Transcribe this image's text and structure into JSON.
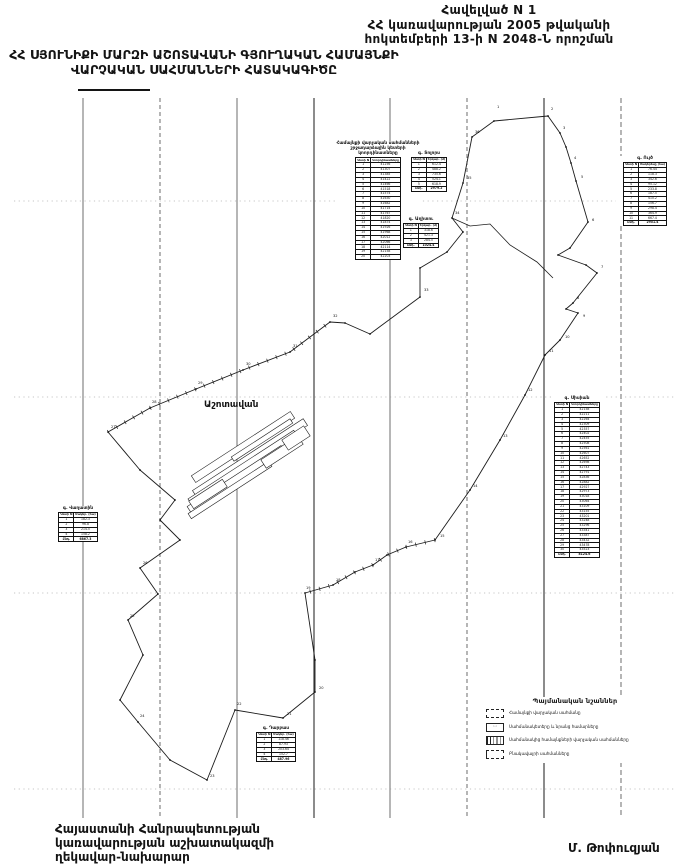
{
  "header": {
    "lines": [
      "Հավելված  N   1",
      "ՀՀ կառավարության 2005 թվականի",
      "հոկտեմբերի 13-ի N 2048-Ն որոշման"
    ]
  },
  "title": {
    "lines": [
      "ՀՀ ՍՅՈՒՆԻՔԻ ՄԱՐԶԻ ԱՇՈՏԱՎԱՆԻ ԳՅՈՒՂԱԿԱՆ ՀԱՄԱՅՆՔԻ",
      "ՎԱՐՉԱԿԱՆ  ՍԱՀՄԱՆՆԵՐԻ  ՀԱՏԱԿԱԳԻԾԸ"
    ]
  },
  "footer": {
    "lines": [
      "Հայաստանի Հանրապետության",
      "կառավարության աշխատակազմի",
      "ղեկավար-նախարար"
    ],
    "signature": "Մ. Թոփուզյան"
  },
  "legend": {
    "title": "Պայմանական նշաններ",
    "items": [
      {
        "label": "Համայնքի վարչական սահմանը"
      },
      {
        "label": "Սահմանակետերը և նրանց համարները"
      },
      {
        "label": "Սահմանակից համայնքների վարչական սահմանները"
      },
      {
        "label": "Բնակավայրի սահմանները"
      }
    ]
  },
  "map": {
    "settlement_label": "Աշոտավան",
    "grid_x": [
      {
        "x": 83
      },
      {
        "x": 160,
        "dash": "4 3"
      },
      {
        "x": 237
      },
      {
        "x": 314,
        "w": 1.1
      },
      {
        "x": 390
      },
      {
        "x": 467,
        "dash": "4 3"
      },
      {
        "x": 544,
        "w": 1.1
      },
      {
        "x": 621,
        "dash": "5 3"
      }
    ],
    "grid_y": [
      201,
      397,
      593,
      789
    ],
    "boundary": [
      [
        108,
        432
      ],
      [
        150,
        408
      ],
      [
        196,
        389
      ],
      [
        243,
        370
      ],
      [
        290,
        352
      ],
      [
        330,
        322
      ],
      [
        345,
        323
      ],
      [
        370,
        334
      ],
      [
        420,
        297
      ],
      [
        420,
        268
      ],
      [
        447,
        252
      ],
      [
        463,
        232
      ],
      [
        452,
        218
      ],
      [
        463,
        183
      ],
      [
        472,
        137
      ],
      [
        494,
        121
      ],
      [
        548,
        116
      ],
      [
        560,
        133
      ],
      [
        566,
        147
      ],
      [
        571,
        163
      ],
      [
        576,
        181
      ],
      [
        588,
        222
      ],
      [
        570,
        248
      ],
      [
        558,
        255
      ],
      [
        586,
        265
      ],
      [
        597,
        273
      ],
      [
        573,
        303
      ],
      [
        566,
        309
      ],
      [
        578,
        313
      ],
      [
        560,
        340
      ],
      [
        545,
        355
      ],
      [
        525,
        395
      ],
      [
        500,
        440
      ],
      [
        470,
        490
      ],
      [
        435,
        540
      ],
      [
        406,
        547
      ],
      [
        387,
        555
      ],
      [
        373,
        565
      ],
      [
        355,
        572
      ],
      [
        333,
        585
      ],
      [
        305,
        593
      ],
      [
        315,
        660
      ],
      [
        315,
        692
      ],
      [
        283,
        718
      ],
      [
        235,
        710
      ],
      [
        207,
        780
      ],
      [
        170,
        760
      ],
      [
        138,
        722
      ],
      [
        120,
        700
      ],
      [
        143,
        655
      ],
      [
        128,
        620
      ],
      [
        158,
        594
      ],
      [
        140,
        568
      ],
      [
        180,
        540
      ],
      [
        160,
        520
      ],
      [
        175,
        500
      ],
      [
        140,
        470
      ]
    ],
    "internal_lines": [
      [
        [
          452,
          218
        ],
        [
          470,
          226
        ],
        [
          490,
          224
        ],
        [
          510,
          245
        ],
        [
          537,
          262
        ],
        [
          553,
          278
        ]
      ]
    ],
    "ticked": [
      [
        [
          108,
          432
        ],
        [
          150,
          408
        ],
        [
          196,
          389
        ],
        [
          243,
          370
        ],
        [
          290,
          352
        ],
        [
          330,
          322
        ]
      ],
      [
        [
          435,
          540
        ],
        [
          406,
          547
        ],
        [
          387,
          555
        ],
        [
          373,
          565
        ],
        [
          355,
          572
        ],
        [
          333,
          585
        ],
        [
          305,
          593
        ]
      ]
    ],
    "settlement_strips": [
      {
        "cx": 243,
        "cy": 447,
        "w": 118,
        "h": 8,
        "a": -33
      },
      {
        "cx": 250,
        "cy": 458,
        "w": 132,
        "h": 8,
        "a": -33
      },
      {
        "cx": 243,
        "cy": 468,
        "w": 126,
        "h": 8,
        "a": -33
      },
      {
        "cx": 236,
        "cy": 479,
        "w": 112,
        "h": 7,
        "a": -33
      },
      {
        "cx": 230,
        "cy": 490,
        "w": 96,
        "h": 6,
        "a": -33
      },
      {
        "cx": 262,
        "cy": 440,
        "w": 70,
        "h": 5,
        "a": -33
      },
      {
        "cx": 282,
        "cy": 452,
        "w": 44,
        "h": 10,
        "a": -33
      },
      {
        "cx": 208,
        "cy": 494,
        "w": 40,
        "h": 9,
        "a": -33
      },
      {
        "cx": 296,
        "cy": 438,
        "w": 26,
        "h": 12,
        "a": -33
      }
    ],
    "point_labels": [
      {
        "x": 497,
        "y": 108,
        "t": "1"
      },
      {
        "x": 551,
        "y": 110,
        "t": "2"
      },
      {
        "x": 563,
        "y": 129,
        "t": "3"
      },
      {
        "x": 574,
        "y": 159,
        "t": "4"
      },
      {
        "x": 581,
        "y": 178,
        "t": "5"
      },
      {
        "x": 592,
        "y": 221,
        "t": "6"
      },
      {
        "x": 601,
        "y": 268,
        "t": "7"
      },
      {
        "x": 577,
        "y": 299,
        "t": "8"
      },
      {
        "x": 583,
        "y": 317,
        "t": "9"
      },
      {
        "x": 565,
        "y": 338,
        "t": "10"
      },
      {
        "x": 549,
        "y": 352,
        "t": "11"
      },
      {
        "x": 528,
        "y": 391,
        "t": "12"
      },
      {
        "x": 503,
        "y": 437,
        "t": "13"
      },
      {
        "x": 473,
        "y": 487,
        "t": "14"
      },
      {
        "x": 440,
        "y": 537,
        "t": "15"
      },
      {
        "x": 408,
        "y": 543,
        "t": "16"
      },
      {
        "x": 375,
        "y": 561,
        "t": "17"
      },
      {
        "x": 336,
        "y": 581,
        "t": "18"
      },
      {
        "x": 306,
        "y": 589,
        "t": "19"
      },
      {
        "x": 319,
        "y": 689,
        "t": "20"
      },
      {
        "x": 287,
        "y": 715,
        "t": "21"
      },
      {
        "x": 237,
        "y": 705,
        "t": "22"
      },
      {
        "x": 210,
        "y": 777,
        "t": "23"
      },
      {
        "x": 140,
        "y": 717,
        "t": "24"
      },
      {
        "x": 130,
        "y": 617,
        "t": "25"
      },
      {
        "x": 143,
        "y": 564,
        "t": "26"
      },
      {
        "x": 111,
        "y": 428,
        "t": "27"
      },
      {
        "x": 152,
        "y": 403,
        "t": "28"
      },
      {
        "x": 198,
        "y": 384,
        "t": "29"
      },
      {
        "x": 246,
        "y": 365,
        "t": "30"
      },
      {
        "x": 293,
        "y": 347,
        "t": "31"
      },
      {
        "x": 333,
        "y": 317,
        "t": "32"
      },
      {
        "x": 424,
        "y": 291,
        "t": "33"
      },
      {
        "x": 455,
        "y": 214,
        "t": "34"
      },
      {
        "x": 467,
        "y": 179,
        "t": "35"
      },
      {
        "x": 475,
        "y": 133,
        "t": "36"
      }
    ]
  },
  "tables": {
    "main": {
      "caption_lines": [
        "Համայնքի վարչական սահմանների",
        "շրջադարձային կետերի",
        "կոորդինատները"
      ],
      "headers": [
        "Կետի N",
        "Կոորդինատները"
      ],
      "rows": [
        [
          "1",
          "41256"
        ],
        [
          "2",
          "41307"
        ],
        [
          "3",
          "41385"
        ],
        [
          "4",
          "41422"
        ],
        [
          "5",
          "41466"
        ],
        [
          "6",
          "41518"
        ],
        [
          "7",
          "41574"
        ],
        [
          "8",
          "41630"
        ],
        [
          "9",
          "41682"
        ],
        [
          "10",
          "41714"
        ],
        [
          "11",
          "41767"
        ],
        [
          "12",
          "41820"
        ],
        [
          "13",
          "41874"
        ],
        [
          "14",
          "41926"
        ],
        [
          "15",
          "41968"
        ],
        [
          "16",
          "42012"
        ],
        [
          "17",
          "42066"
        ],
        [
          "18",
          "42114"
        ],
        [
          "19",
          "42158"
        ],
        [
          "20",
          "42203"
        ]
      ]
    },
    "tolors": {
      "caption": "գ. Տոլորս",
      "headers": [
        "Կետի N",
        "Երկար. (մ)"
      ],
      "rows": [
        [
          "1",
          "612.4"
        ],
        [
          "2",
          "488.2"
        ],
        [
          "3",
          "735.6"
        ],
        [
          "4",
          "524.1"
        ],
        [
          "5",
          "618.9"
        ]
      ],
      "total": [
        "Ընդ.",
        "2979.2"
      ]
    },
    "aghitu": {
      "caption": "գ. Աղիտու",
      "headers": [
        "Կետի N",
        "Երկար. (մ)"
      ],
      "rows": [
        [
          "1",
          "318.6"
        ],
        [
          "2",
          "421.3"
        ],
        [
          "3",
          "284.5"
        ]
      ],
      "total": [
        "Ընդ.",
        "1024.4"
      ]
    },
    "uyts": {
      "caption": "գ. Ույծ",
      "headers": [
        "Կետի N",
        "Մակերեսը (հա)"
      ],
      "rows": [
        [
          "1",
          "76.44"
        ],
        [
          "2",
          "118.3"
        ],
        [
          "3",
          "342.6"
        ],
        [
          "4",
          "95.12"
        ],
        [
          "5",
          "233.8"
        ],
        [
          "6",
          "187.5"
        ],
        [
          "7",
          "410.2"
        ],
        [
          "8",
          "156.7"
        ],
        [
          "9",
          "298.4"
        ],
        [
          "10",
          "364.9"
        ],
        [
          "11",
          "667.4"
        ]
      ],
      "total": [
        "Ընդ.",
        "2951.4"
      ]
    },
    "sisian": {
      "caption": "գ. Սիսիան",
      "headers": [
        "Կետի N",
        "Կոորդինատները"
      ],
      "rows": [
        [
          "1",
          "42158"
        ],
        [
          "2",
          "42211"
        ],
        [
          "3",
          "42264"
        ],
        [
          "4",
          "42309"
        ],
        [
          "5",
          "42357"
        ],
        [
          "6",
          "42402"
        ],
        [
          "7",
          "42455"
        ],
        [
          "8",
          "42508"
        ],
        [
          "9",
          "42561"
        ],
        [
          "10",
          "42607"
        ],
        [
          "11",
          "42652"
        ],
        [
          "12",
          "42698"
        ],
        [
          "13",
          "42743"
        ],
        [
          "14",
          "42791"
        ],
        [
          "15",
          "42836"
        ],
        [
          "16",
          "42882"
        ],
        [
          "17",
          "42927"
        ],
        [
          "18",
          "42973"
        ],
        [
          "19",
          "43018"
        ],
        [
          "20",
          "43064"
        ],
        [
          "21",
          "43109"
        ],
        [
          "22",
          "43155"
        ],
        [
          "23",
          "43201"
        ],
        [
          "24",
          "43248"
        ],
        [
          "25",
          "43296"
        ],
        [
          "26",
          "43341"
        ],
        [
          "27",
          "43387"
        ],
        [
          "28",
          "43432"
        ],
        [
          "29",
          "43478"
        ],
        [
          "30",
          "43523"
        ]
      ],
      "total": [
        "Ընդ.",
        "8124.6"
      ]
    },
    "vaghatin": {
      "caption": "գ. Վաղատին",
      "headers": [
        "Կետի N",
        "Մակեր. (հա)"
      ],
      "rows": [
        [
          "1",
          "182.3"
        ],
        [
          "2",
          "96.8"
        ],
        [
          "3",
          "214.5"
        ],
        [
          "4",
          "158.2"
        ]
      ],
      "total": [
        "Ընդ.",
        "6867.3"
      ]
    },
    "darbas": {
      "caption": "գ. Դարբաս",
      "headers": [
        "Կետի N",
        "Մակեր. (հա)"
      ],
      "rows": [
        [
          "1",
          "118.46"
        ],
        [
          "2",
          "87.93"
        ],
        [
          "3",
          "203.64"
        ],
        [
          "4",
          "152.7"
        ]
      ],
      "total": [
        "Ընդ.",
        "487.96"
      ]
    }
  }
}
